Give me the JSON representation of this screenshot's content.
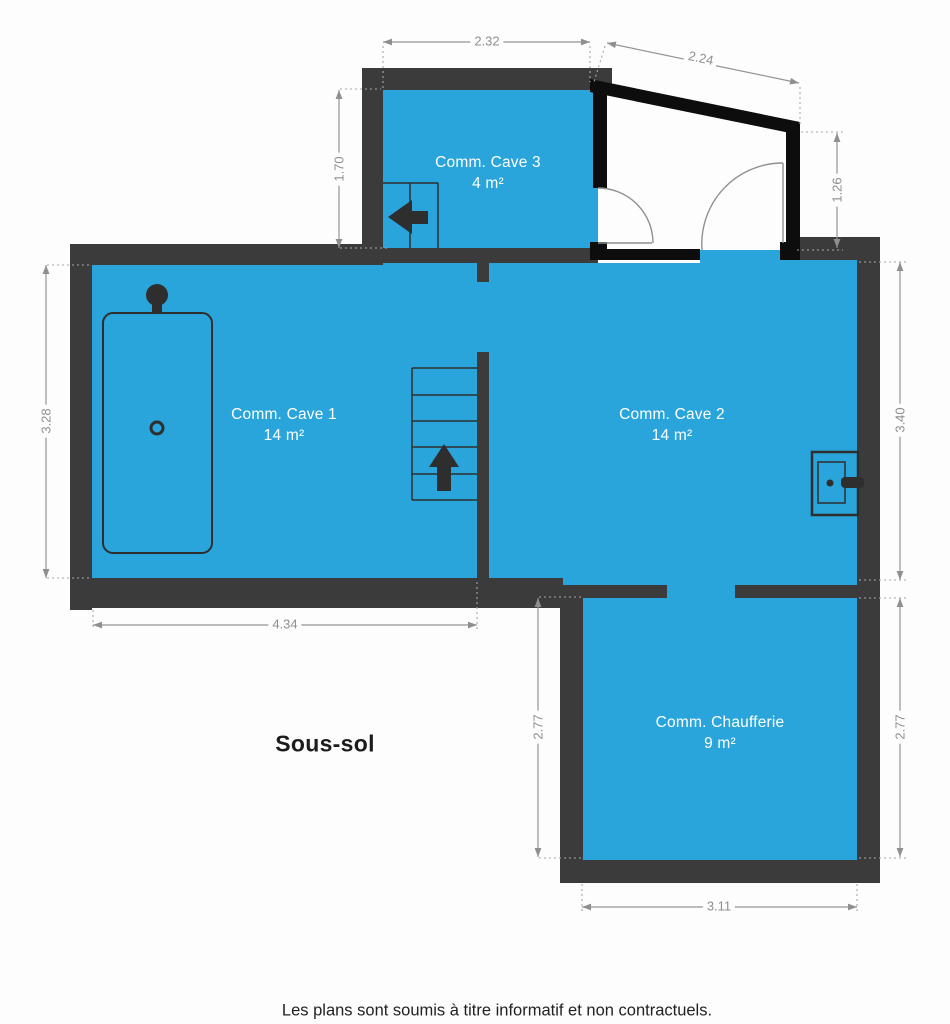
{
  "plan": {
    "title": "Sous-sol",
    "rooms": [
      {
        "name": "Comm. Cave 3",
        "area": "4 m²"
      },
      {
        "name": "Comm. Cave 1",
        "area": "14 m²"
      },
      {
        "name": "Comm. Cave 2",
        "area": "14 m²"
      },
      {
        "name": "Comm. Chaufferie",
        "area": "9 m²"
      }
    ],
    "dimensions": {
      "cave3_top_width": "2.32",
      "entrance_slope_width": "2.24",
      "cave3_left_height": "1.70",
      "entrance_right_height": "1.26",
      "cave1_left_height": "3.28",
      "cave2_right_height": "3.40",
      "cave1_bottom_width": "4.34",
      "chaufferie_left_height": "2.77",
      "chaufferie_right_height": "2.77",
      "chaufferie_bottom_width": "3.11"
    },
    "fixtures": [
      "bathtub",
      "sink",
      "stairs-up",
      "stairs-cave3",
      "door-swing-left",
      "door-swing-right"
    ],
    "colors": {
      "room_fill": "#29a5dc",
      "wall": "#3b3b3b",
      "black_wall": "#0d0d0d",
      "dimension": "#8f8f8f"
    }
  },
  "footer": {
    "disclaimer": "Les plans sont soumis à titre informatif et non contractuels."
  }
}
